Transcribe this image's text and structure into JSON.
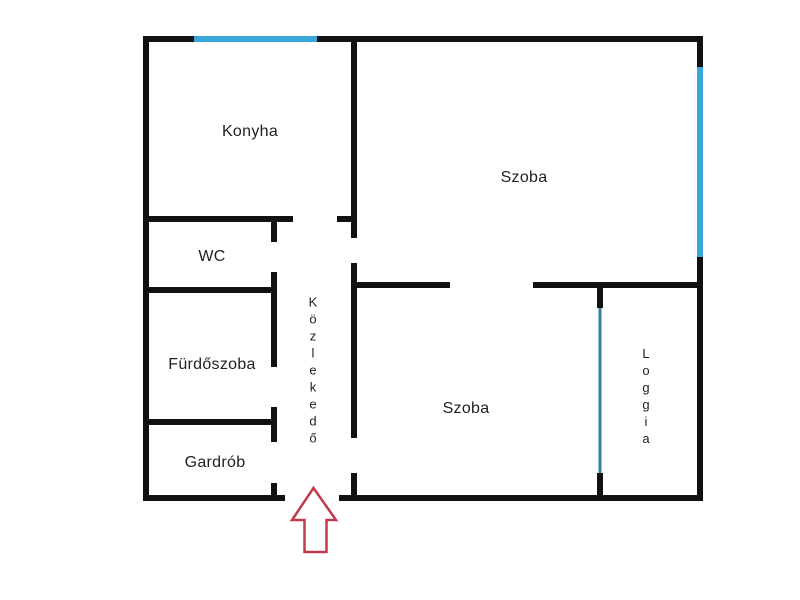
{
  "colors": {
    "wall": "#111111",
    "window": "#38a7d8",
    "loggia_window": "#34809e",
    "arrow": "#c23b4c",
    "text": "#1f1f1f",
    "background": "#ffffff"
  },
  "rooms": {
    "konyha": {
      "label": "Konyha"
    },
    "wc": {
      "label": "WC"
    },
    "furdoszoba": {
      "label": "Fürdőszoba"
    },
    "gardrob": {
      "label": "Gardrób"
    },
    "kozlekedo": {
      "label": "Közlekedő"
    },
    "szoba_felso": {
      "label": "Szoba"
    },
    "szoba_also": {
      "label": "Szoba"
    },
    "loggia": {
      "label": "Loggia"
    }
  }
}
